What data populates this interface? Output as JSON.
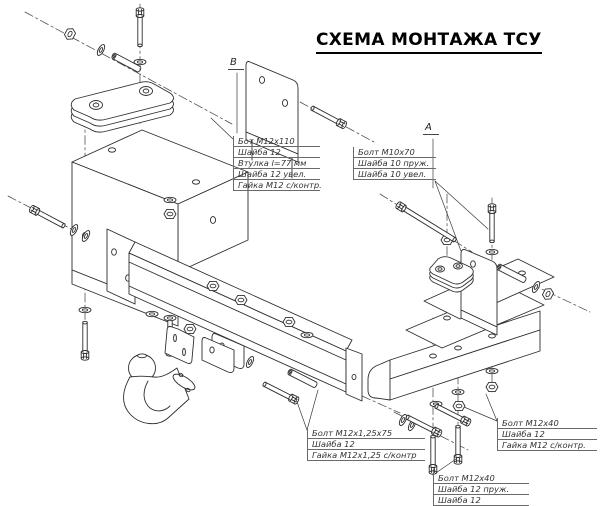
{
  "title": "СХЕМА МОНТАЖА ТСУ",
  "markers": {
    "a": "А",
    "b": "В"
  },
  "parts_labels": [
    {
      "name": "left-upper-fasteners",
      "lines": [
        "Бот М12х110",
        "Шайба 12",
        "Втулка l=77 мм",
        "Шайба 12 увел.",
        "Гайка М12 с/контр."
      ]
    },
    {
      "name": "right-upper-fasteners",
      "lines": [
        "Болт М10х70",
        "Шайба 10 пруж.",
        "Шайба 10 увел."
      ]
    },
    {
      "name": "beam-lower-fasteners",
      "lines": [
        "Болт М12х1,25х75",
        "Шайба 12",
        "Гайка М12х1,25 с/контр"
      ]
    },
    {
      "name": "right-side-fasteners",
      "lines": [
        "Болт М12х40",
        "Шайба 12",
        "Гайка М12 с/контр."
      ]
    },
    {
      "name": "right-lower-fasteners",
      "lines": [
        "Болт М12х40",
        "Шайба 12 пруж.",
        "Шайба 12"
      ]
    }
  ],
  "colors": {
    "background": "#ffffff",
    "line": "#2e2e2e",
    "text": "#000000",
    "label_text": "#333333",
    "label_rule": "#6a6a6a"
  }
}
